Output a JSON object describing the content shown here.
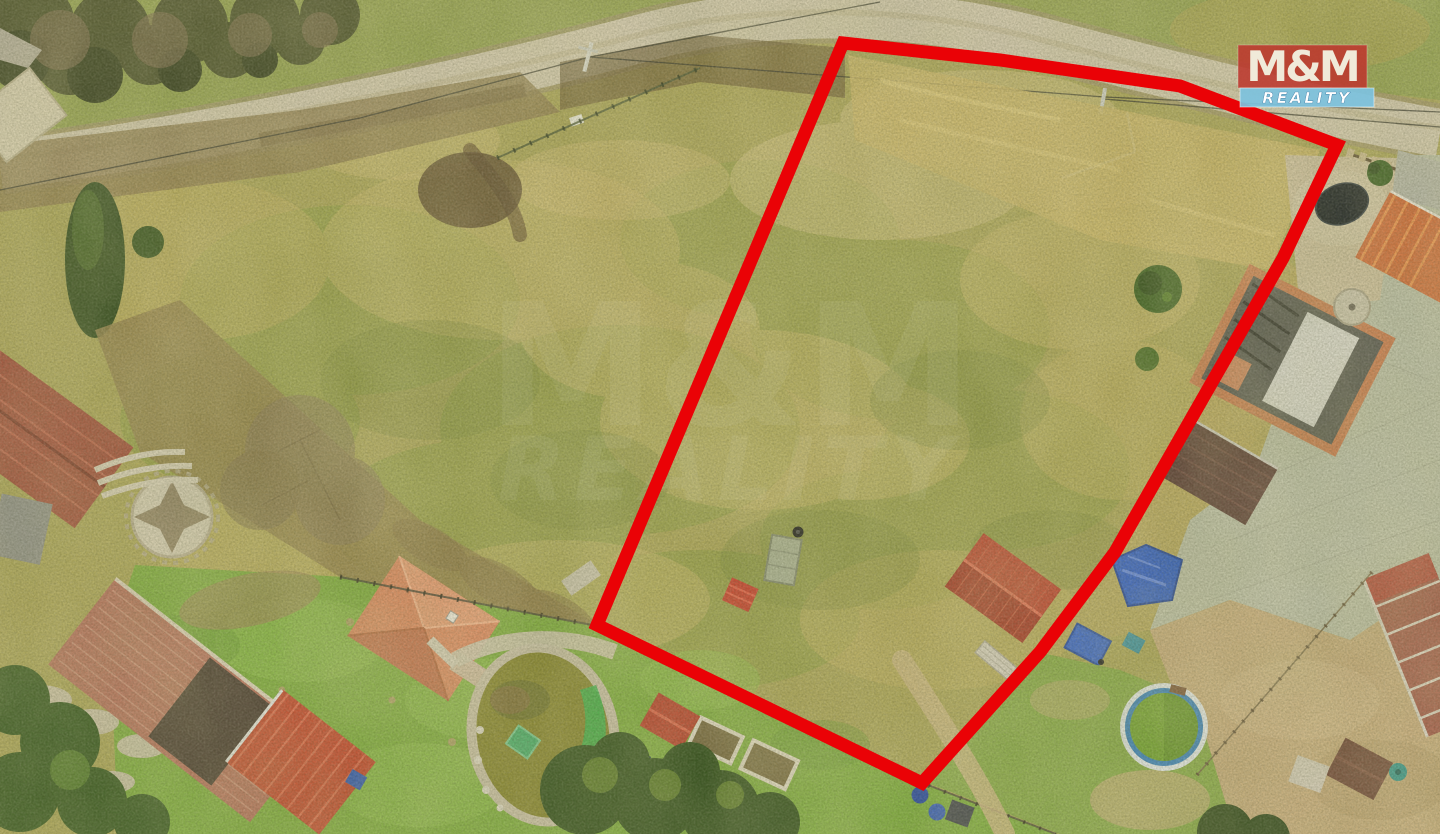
{
  "meta": {
    "type": "aerial-drone-photograph",
    "subject": "grassy building plot outlined with a red boundary, surrounded by village houses, gardens, a dirt road and ponds"
  },
  "logo": {
    "line1": "M&M",
    "line2": "REALITY",
    "box1_color": "#bc382d",
    "box2_color": "#7dc2de",
    "text_color": "#f0ead9"
  },
  "watermark": {
    "line1": "M&M",
    "line2": "REALITY"
  },
  "boundary": {
    "color": "#ea0206",
    "stroke_width_px": 13,
    "vertices": [
      [
        843,
        43
      ],
      [
        1000,
        60
      ],
      [
        1180,
        86
      ],
      [
        1337,
        145
      ],
      [
        1283,
        258
      ],
      [
        1115,
        552
      ],
      [
        1040,
        652
      ],
      [
        922,
        783
      ],
      [
        597,
        625
      ]
    ]
  },
  "scene_features": [
    {
      "name": "dirt-road",
      "color": "#cfc5ac"
    },
    {
      "name": "meadow-plot",
      "color": "#aca658"
    },
    {
      "name": "dried-grass-strip",
      "color": "#c9b469"
    },
    {
      "name": "red-gable-shed-in-plot",
      "color": "#b8432e"
    },
    {
      "name": "garden-pond-green-water",
      "color": "#85832f"
    },
    {
      "name": "ornamental-pond-dark-water",
      "color": "#202527"
    },
    {
      "name": "round-pool-green-water",
      "color": "#709f2f"
    },
    {
      "name": "old-barn-tile-roof",
      "color": "#b3715c"
    },
    {
      "name": "house-under-construction",
      "color": "#56564f"
    },
    {
      "name": "paved-yard",
      "color": "#b9bca4"
    },
    {
      "name": "blue-tarp",
      "color": "#2857c2"
    },
    {
      "name": "hip-roof-house",
      "color": "#d8875f"
    },
    {
      "name": "stone-star-patio",
      "color": "#cfc7ae"
    }
  ]
}
